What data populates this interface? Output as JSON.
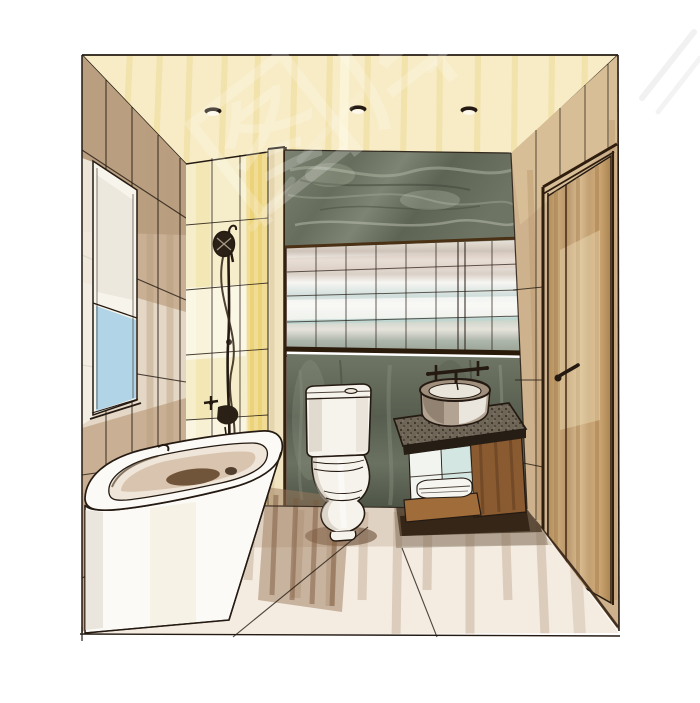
{
  "image": {
    "kind": "hand-drawn marker and ink interior perspective sketch",
    "subject": "small bathroom with bathtub, toilet, vanity and entry door",
    "counts": {
      "downlights": 3
    }
  },
  "watermark": {
    "text": "图库",
    "color": "#ffffff"
  },
  "palette": {
    "page_bg": "#ffffff",
    "ink": "#241a12",
    "ceiling": "#f7ecc6",
    "left_wall": "#c9b094",
    "shower_wall": "#f6eecb",
    "accent_yellow": "#ecd276",
    "window_glass": "#a9d1e6",
    "window_frame": "#f4f1ea",
    "partition": "#f0e5c0",
    "marble_upper": "#6e7465",
    "marble_lower": "#5a6152",
    "mirror": "#e9e6de",
    "tub": "#fbfaf6",
    "toilet": "#f6f3ec",
    "counter": "#6e6557",
    "wood": "#8a5a30",
    "wood_dark": "#5b3a1d",
    "towels": "#f7f5f0",
    "sink": "#b3a393",
    "door": "#c2a176",
    "door_frame": "#3c2817",
    "right_wall": "#cdb28d",
    "floor": "#f4ece1",
    "floor_shadow": "#8a6d55"
  },
  "scene": {
    "objects": [
      "ceiling-downlights",
      "tiled-left-wall",
      "window",
      "hand-shower-on-slide-bar",
      "tub-faucet",
      "bathtub",
      "half-height-partition",
      "marble-feature-wall",
      "mirrored-cabinet",
      "two-piece-toilet",
      "stone-top-vanity",
      "vessel-sink",
      "wall-mounted-faucet",
      "folded-towels",
      "entry-door-with-lever-handle",
      "tiled-floor"
    ]
  }
}
